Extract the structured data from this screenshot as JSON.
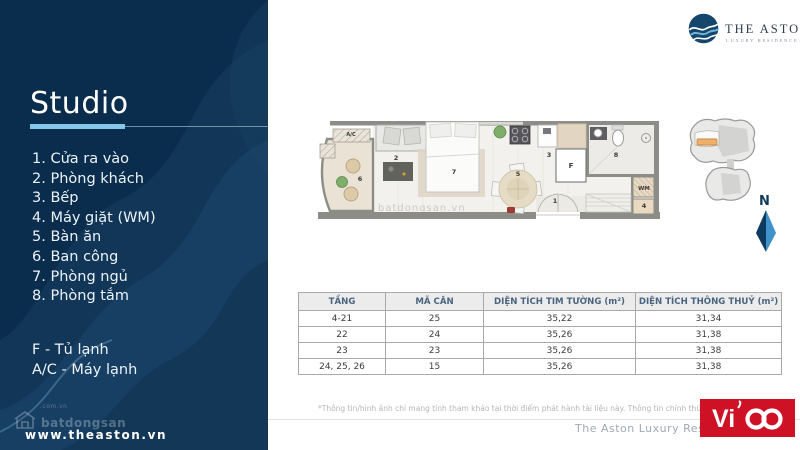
{
  "sidebar": {
    "title": "Studio",
    "legend": [
      "1. Cửa ra vào",
      "2. Phòng khách",
      "3. Bếp",
      "4. Máy giặt (WM)",
      "5. Bàn ăn",
      "6. Ban công",
      "7. Phòng ngủ",
      "8. Phòng tắm"
    ],
    "notes": [
      "F - Tủ lạnh",
      "A/C - Máy lạnh"
    ],
    "watermark_small": ".com.vn",
    "watermark_big": "batdongsan",
    "website": "www.theaston.vn"
  },
  "brand": {
    "name": "THE ASTON",
    "tagline": "LUXURY RESIDENCE"
  },
  "floorplan": {
    "labels": {
      "entry": "1",
      "living": "2",
      "kitchen": "3",
      "washer": "4",
      "dining": "5",
      "balcony": "6",
      "bedroom": "7",
      "bathroom": "8",
      "ac": "A/C",
      "wm": "WM",
      "fridge": "F"
    },
    "watermark": "batdongsan.vn",
    "north": "N"
  },
  "table": {
    "headers": [
      "TẦNG",
      "MÃ CĂN",
      "DIỆN TÍCH TIM TƯỜNG (m²)",
      "DIỆN TÍCH THÔNG THUỶ (m²)"
    ],
    "rows": [
      [
        "4-21",
        "25",
        "35,22",
        "31,34"
      ],
      [
        "22",
        "24",
        "35,26",
        "31,38"
      ],
      [
        "23",
        "23",
        "35,26",
        "31,38"
      ],
      [
        "24, 25, 26",
        "15",
        "35,26",
        "31,38"
      ]
    ]
  },
  "footer": {
    "disclaimer": "*Thông tin/hình ảnh chỉ mang tính tham khảo tại thời điểm phát hành tài liệu này. Thông tin chính thức căn cứ t",
    "project": "The Aston Luxury Res",
    "vico_text": "Vi"
  },
  "colors": {
    "sidebar_navy": "#0a2d4d",
    "accent_blue": "#85c7e8",
    "vico_red": "#cf1126",
    "brand_navy": "#16466c",
    "unit_highlight_orange": "#efb06b"
  }
}
